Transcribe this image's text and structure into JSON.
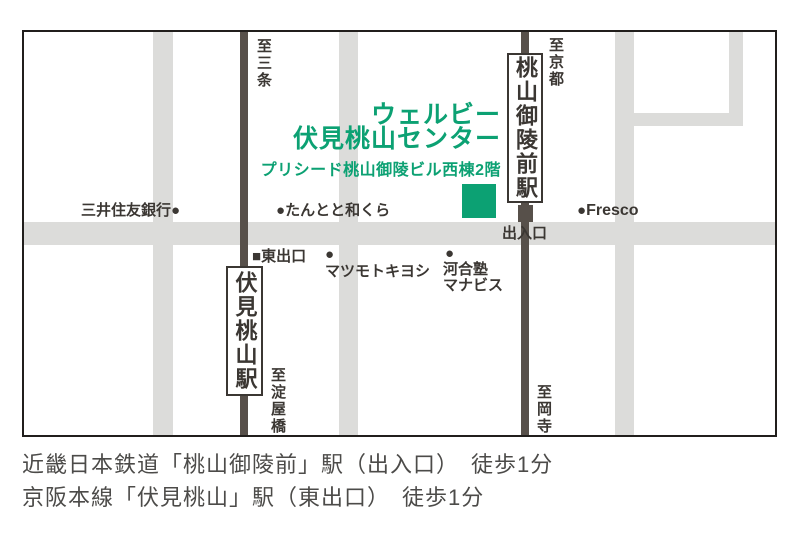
{
  "colors": {
    "road": "#dcdcda",
    "rail": "#57504a",
    "ink": "#3b3733",
    "green": "#0ca173",
    "border": "#211e1c",
    "footer_ink": "#4c4b49"
  },
  "icons": {
    "poi_dot": "●",
    "exit_square": "■"
  },
  "center": {
    "name_line1": "ウェルビー",
    "name_line2": "伏見桃山センター",
    "building": "プリシード桃山御陵ビル西棟2階"
  },
  "stations": {
    "momoyamagoryomae": "桃山御陵前駅",
    "fushimimomoyama": "伏見桃山駅"
  },
  "directions": {
    "sanjo": "至三条",
    "kyoto": "至京都",
    "yodoyabashi": "至淀屋橋",
    "okadera": "至岡寺"
  },
  "pois": {
    "bank": "三井住友銀行",
    "tantoto": "たんとと和くら",
    "fresco": "Fresco",
    "matsumotokiyoshi": "マツモトキヨシ",
    "kawaijuku_line1": "河合塾",
    "kawaijuku_line2": "マナビス"
  },
  "exits": {
    "deiriguchi": "出入口",
    "higashideguchi": "東出口"
  },
  "footer": {
    "line1": "近畿日本鉄道「桃山御陵前」駅（出入口）　徒歩1分",
    "line2": "京阪本線「伏見桃山」駅（東出口）　徒歩1分"
  }
}
